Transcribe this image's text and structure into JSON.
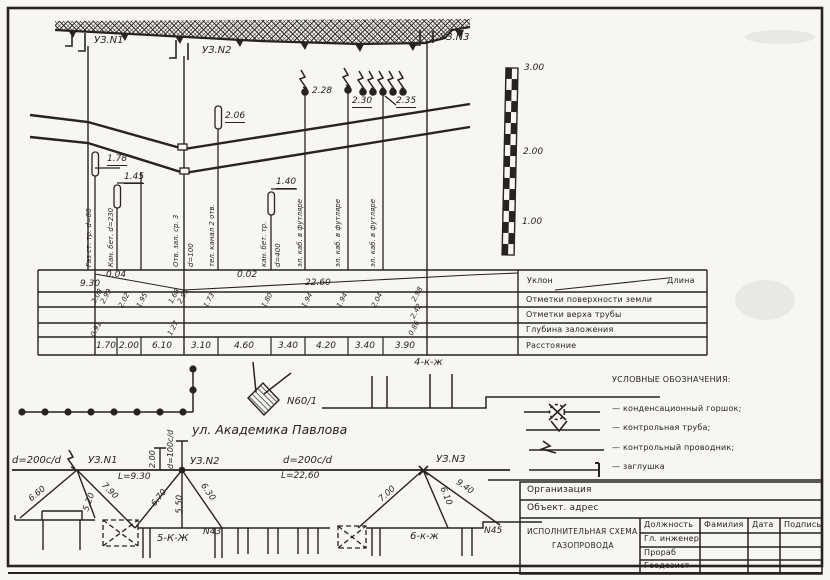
{
  "colors": {
    "ink": "#27241f",
    "paper": "#f7f6f1"
  },
  "stations": {
    "uz1": "УЗ.N1",
    "uz2": "УЗ.N2",
    "uz3": "УЗ.N3"
  },
  "profile": {
    "marks": {
      "m178": "1.78",
      "m145": "1.45",
      "m206": "2.06",
      "m140": "1.40",
      "m228": "2.28",
      "m230": "2.30",
      "m235": "2.35"
    },
    "utilities": [
      "Газ ст. тр. d=80",
      "Кан. бет. d=230",
      "Отв. зал. ср. 3",
      "d=100",
      "тел. канал 2 отв.",
      "кан. бет. тр.",
      "d=400",
      "эл. каб. в футляре",
      "эл. каб. в футляре",
      "эл. каб. в футляре"
    ],
    "scale_marks": [
      "3.00",
      "2.00",
      "1.00"
    ]
  },
  "table": {
    "headers": {
      "slope": "Уклон",
      "length": "Длина",
      "surface": "Отметки поверхности земли",
      "pipe_top": "Отметки верха трубы",
      "depth": "Глубина заложения",
      "distance": "Расстояние"
    },
    "segments": [
      {
        "slope": "0.04",
        "length": "9.30"
      },
      {
        "slope": "0.02",
        "length": "22.60"
      }
    ],
    "marks": [
      "2.08",
      "2.99",
      "2.02",
      "1.95",
      "1.68",
      "2.95",
      "1.73",
      "1.80",
      "1.94",
      "1.94",
      "2.04",
      "2.98",
      "2.42"
    ],
    "depths": [
      "0.91",
      "1.27",
      "0.86"
    ],
    "distances": [
      "1.70",
      "2.00",
      "6.10",
      "3.10",
      "4.60",
      "3.40",
      "4.20",
      "3.40",
      "3.90"
    ]
  },
  "plan": {
    "building": "N60/1",
    "street": "ул. Академика Павлова",
    "house4": "4-к-ж"
  },
  "abris": {
    "d200_left": "d=200c/d",
    "d200_right": "d=200c/d",
    "d100": "d=100c/d",
    "len1": "L=9.30",
    "len2": "L=22,60",
    "dim200": "2.00",
    "ties": [
      "6.60",
      "5.20",
      "7.90",
      "6.70",
      "5.50",
      "6.30",
      "7.00",
      "6.10",
      "9.40"
    ],
    "house5": "5-К-Ж",
    "house6": "6-к-ж",
    "n43": "N43",
    "n45": "N45"
  },
  "legend": {
    "title": "УСЛОВНЫЕ ОБОЗНАЧЕНИЯ:",
    "items": [
      "— конденсационный горшок;",
      "— контрольная труба;",
      "— контрольный проводник;",
      "— заглушка"
    ]
  },
  "title_block": {
    "org": "Организация",
    "object": "Объект. адрес",
    "doc_title_1": "ИСПОЛНИТЕЛЬНАЯ СХЕМА",
    "doc_title_2": "ГАЗОПРОВОДА",
    "cols": [
      "Должность",
      "Фамилия",
      "Дата",
      "Подпись"
    ],
    "rows": [
      "Гл. инженер",
      "Прораб",
      "Геодезист"
    ]
  }
}
